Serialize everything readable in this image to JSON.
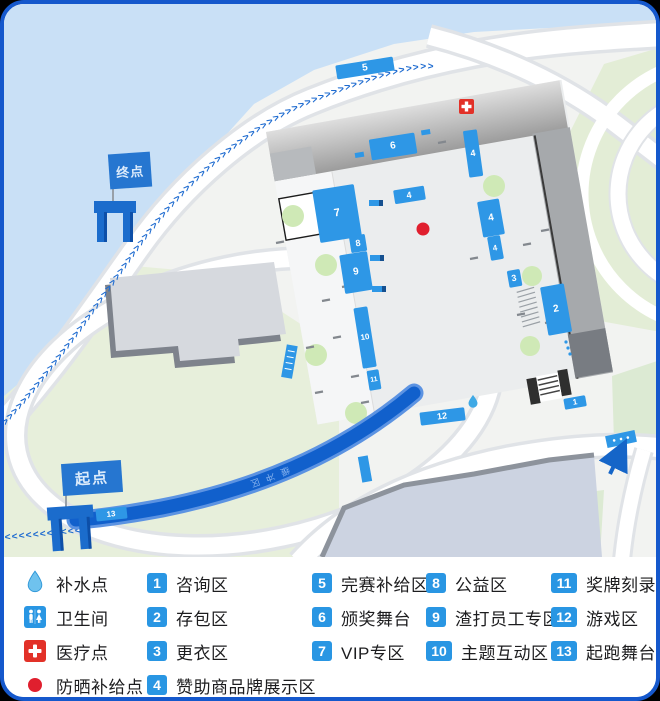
{
  "card": {
    "border_color": "#1558cc",
    "background_outside": "#000000"
  },
  "map": {
    "finish_flag_label": "终点",
    "start_flag_label": "起点",
    "corridor_label": "缓冲区",
    "route_chevrons": ">>>>>>>>>>>>>>>>>>>>>>>>>>>>>>>>>>>>>>>>>>>>>>>>>>>>>>>>>>>>>>>>>>>>>>>>>>>>>>>>>>>>",
    "start_chevrons": "<<<<<<<<<<<<",
    "point_icons": [
      {
        "icon": "medical-cross-icon",
        "meaning": "医疗点"
      },
      {
        "icon": "water-drop-icon",
        "meaning": "补水点"
      },
      {
        "icon": "sun-supply-dot-icon",
        "meaning": "防晒补给点"
      }
    ],
    "colors": {
      "water": "#c9e0f6",
      "park_green": "#e7efdb",
      "road": "#ffffff",
      "marker_blue": "#2e97e6",
      "route_blue": "#1160cc",
      "chevron_blue": "#1e6bd0",
      "medical_red": "#e23128",
      "sun_dot_red": "#e01f2e"
    }
  },
  "legend": {
    "facilities": [
      {
        "icon": "water-drop-icon",
        "label": "补水点"
      },
      {
        "icon": "restroom-icon",
        "label": "卫生间"
      },
      {
        "icon": "medical-cross-icon",
        "label": "医疗点"
      },
      {
        "icon": "sun-supply-dot-icon",
        "label": "防晒补给点"
      }
    ],
    "zones": [
      {
        "num": "1",
        "label": "咨询区"
      },
      {
        "num": "2",
        "label": "存包区"
      },
      {
        "num": "3",
        "label": "更衣区"
      },
      {
        "num": "4",
        "label": "赞助商品牌展示区"
      },
      {
        "num": "5",
        "label": "完赛补给区"
      },
      {
        "num": "6",
        "label": "颁奖舞台"
      },
      {
        "num": "7",
        "label": "VIP专区"
      },
      {
        "num": "8",
        "label": "公益区"
      },
      {
        "num": "9",
        "label": "渣打员工专区"
      },
      {
        "num": "10",
        "label": "主题互动区"
      },
      {
        "num": "11",
        "label": "奖牌刻录"
      },
      {
        "num": "12",
        "label": "游戏区"
      },
      {
        "num": "13",
        "label": "起跑舞台"
      }
    ],
    "badge_color": "#2996e3"
  }
}
